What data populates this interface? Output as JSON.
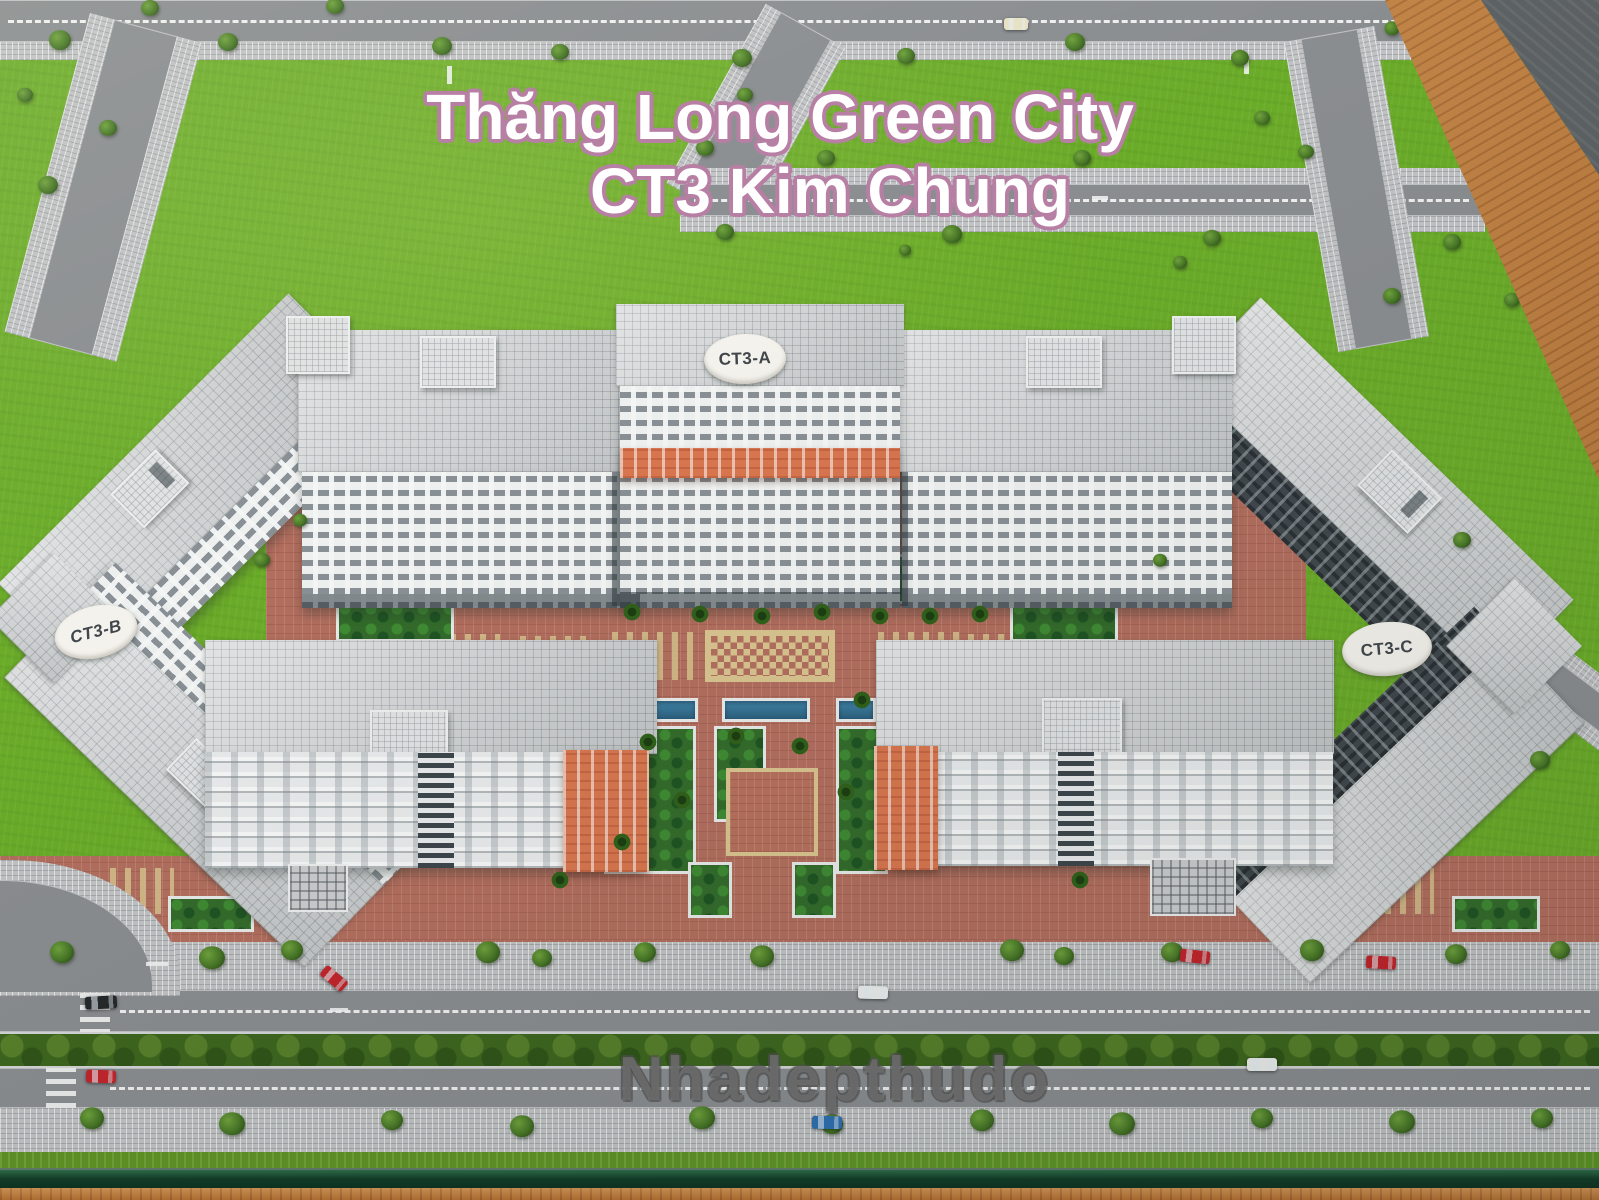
{
  "title": {
    "line1": "Thăng Long Green City",
    "line2": "CT3 Kim Chung"
  },
  "watermark_text": "Nhadepthudo",
  "badges": {
    "a": "CT3-A",
    "b": "CT3-B",
    "c": "CT3-C"
  },
  "palette": {
    "grass": "#6aab28",
    "road_asphalt": "#8a8d90",
    "sidewalk_cobble": "#c0c2c4",
    "roof_tile": "#d6d8d9",
    "facade_white": "#eef0f0",
    "facade_shadow": "#41484d",
    "accent_orange": "#d8764f",
    "plaza_red": "#b26e5e",
    "mosaic_tan": "#d9c48f",
    "pool_blue": "#2b5f7d",
    "median_green": "#3d661e",
    "model_edge_green": "#123c28",
    "table_wood": "#c9813e",
    "title_fill": "#ffffff",
    "title_outline": "#b77fa4",
    "badge_text": "#41464b"
  },
  "vehicles": [
    {
      "color": "#26282a",
      "x": 85,
      "y": 996,
      "angle": -3,
      "w": 32,
      "h": 13
    },
    {
      "color": "#c1242b",
      "x": 320,
      "y": 972,
      "angle": 40,
      "w": 28,
      "h": 13
    },
    {
      "color": "#c1242b",
      "x": 86,
      "y": 1070,
      "angle": 2,
      "w": 30,
      "h": 13
    },
    {
      "color": "#eceded",
      "x": 858,
      "y": 986,
      "angle": 1,
      "w": 30,
      "h": 13
    },
    {
      "color": "#c1242b",
      "x": 1180,
      "y": 950,
      "angle": 6,
      "w": 30,
      "h": 13
    },
    {
      "color": "#c1242b",
      "x": 1366,
      "y": 956,
      "angle": 3,
      "w": 30,
      "h": 13
    },
    {
      "color": "#eceded",
      "x": 1247,
      "y": 1058,
      "angle": 0,
      "w": 30,
      "h": 13
    },
    {
      "color": "#2d6fb0",
      "x": 812,
      "y": 1116,
      "angle": 1,
      "w": 30,
      "h": 13
    },
    {
      "color": "#e6e0c4",
      "x": 1004,
      "y": 18,
      "angle": 0,
      "w": 24,
      "h": 12
    }
  ]
}
